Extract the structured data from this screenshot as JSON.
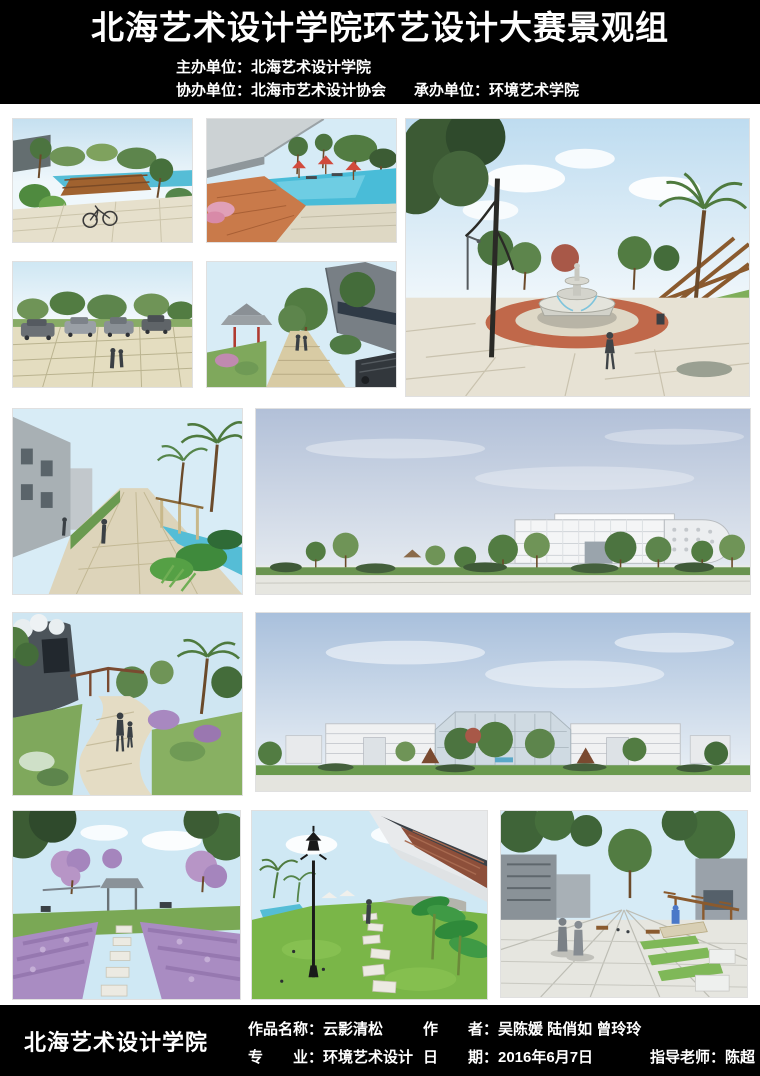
{
  "header": {
    "title": "北海艺术设计学院环艺设计大赛景观组",
    "host": "主办单位：北海艺术设计学院",
    "co_organizer": "协办单位：北海市艺术设计协会",
    "undertaker": "承办单位：环境艺术学院"
  },
  "gallery": [
    {
      "id": "pool-bridge",
      "desc": "滨水木桥与自行车景观效果图"
    },
    {
      "id": "umbrella-pool",
      "desc": "红伞泳池木平台景观效果图"
    },
    {
      "id": "parking-lot",
      "desc": "生态停车场景观效果图"
    },
    {
      "id": "pavilion-path",
      "desc": "中式凉亭步道景观效果图"
    },
    {
      "id": "fountain-plaza",
      "desc": "喷泉广场与木构廊架景观效果图"
    },
    {
      "id": "palm-walkway",
      "desc": "棕榈步行道与水渠景观效果图"
    },
    {
      "id": "building-elevation",
      "desc": "教学楼沿街立面景观效果图"
    },
    {
      "id": "garden-path-family",
      "desc": "曲线园路与花架景观效果图"
    },
    {
      "id": "campus-panorama",
      "desc": "校园建筑群全景效果图"
    },
    {
      "id": "wisteria-garden",
      "desc": "紫花花境汀步景观效果图"
    },
    {
      "id": "lawn-lamp",
      "desc": "草坪路灯汀步景观效果图"
    },
    {
      "id": "promenade",
      "desc": "步行广场绿化台地景观效果图"
    }
  ],
  "footer": {
    "school": "北海艺术设计学院",
    "work": "作品名称：云影清松",
    "author": "作　　者：吴陈媛 陆俏如 曾玲玲",
    "major": "专　　业：环境艺术设计",
    "date": "日　　期：2016年6月7日",
    "advisor": "指导老师：陈超"
  },
  "colors": {
    "header_bg": "#000000",
    "header_text": "#ffffff",
    "footer_bg": "#000000",
    "footer_text": "#ffffff",
    "page_bg": "#ffffff",
    "pool_blue": "#55bdd6",
    "umbrella_red": "#d14a3c",
    "terracotta_ring": "#c0684a",
    "wisteria_purple": "#a98cc2",
    "lawn_green": "#7ab648"
  }
}
